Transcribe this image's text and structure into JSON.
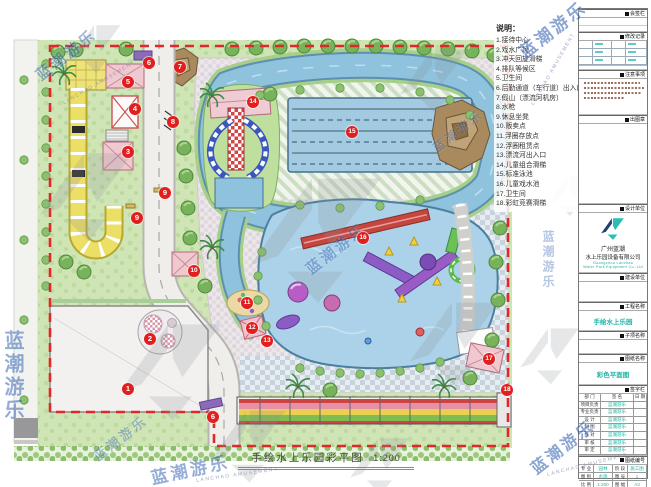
{
  "watermark": {
    "brand_cn": "蓝潮游乐",
    "brand_en": "LANCHAO AMUSEMENT"
  },
  "legend": {
    "title": "说明：",
    "items": [
      "1.接待中心",
      "2.戏水广场",
      "3.冲天回旋滑梯",
      "4.排队等候区",
      "5.卫生间",
      "6.后勤通道（车行道）出入口",
      "7.假山（漂流河机房）",
      "8.水枪",
      "9.休息坐凳",
      "10.贩卖点",
      "11.浮圈存放点",
      "12.浮圈租赁点",
      "13.漂流河出入口",
      "14.儿童组合滑梯",
      "15.标准泳池",
      "16.儿童戏水池",
      "17.卫生间",
      "18.彩虹竞赛滑梯"
    ]
  },
  "plan": {
    "title": "手绘水上乐园彩平图",
    "scale": "1:200",
    "markers": [
      {
        "num": "1",
        "x": 128,
        "y": 389
      },
      {
        "num": "2",
        "x": 150,
        "y": 339
      },
      {
        "num": "3",
        "x": 128,
        "y": 152
      },
      {
        "num": "4",
        "x": 135,
        "y": 109
      },
      {
        "num": "5",
        "x": 128,
        "y": 82
      },
      {
        "num": "6",
        "x": 149,
        "y": 63
      },
      {
        "num": "6",
        "x": 213,
        "y": 417
      },
      {
        "num": "7",
        "x": 180,
        "y": 67
      },
      {
        "num": "8",
        "x": 173,
        "y": 122
      },
      {
        "num": "9",
        "x": 165,
        "y": 193
      },
      {
        "num": "9",
        "x": 137,
        "y": 218
      },
      {
        "num": "10",
        "x": 194,
        "y": 271
      },
      {
        "num": "11",
        "x": 247,
        "y": 303
      },
      {
        "num": "12",
        "x": 252,
        "y": 328
      },
      {
        "num": "13",
        "x": 267,
        "y": 341
      },
      {
        "num": "14",
        "x": 253,
        "y": 102
      },
      {
        "num": "15",
        "x": 352,
        "y": 132
      },
      {
        "num": "16",
        "x": 363,
        "y": 238
      },
      {
        "num": "17",
        "x": 489,
        "y": 359
      },
      {
        "num": "18",
        "x": 507,
        "y": 390
      }
    ]
  },
  "titleblock": {
    "sections": {
      "s1": "会签栏",
      "s2": "修改记录",
      "s3": "注意事项",
      "s4": "出图章",
      "s5": "设计单位",
      "s6": "建设单位",
      "s7": "工程名称",
      "s8": "子项名称",
      "s9": "图纸名称",
      "s10": "签字栏",
      "s11": "图纸编号"
    },
    "company": {
      "name_line1": "广州蓝潮",
      "name_line2": "水上乐园设备有限公司",
      "en_line1": "Guangzhou Lanchao",
      "en_line2": "Water Park Equipment Co.,Ltd"
    },
    "project_name": "手绘水上乐园",
    "drawing_name": "彩色平面图",
    "sign_table": {
      "header": [
        "部 门",
        "签 名",
        "日 期"
      ],
      "rows": [
        [
          "项目负责人",
          "蓝潮游乐"
        ],
        [
          "专业负责人",
          "蓝潮游乐"
        ],
        [
          "设 计",
          "蓝潮游乐"
        ],
        [
          "制 图",
          "蓝潮游乐"
        ],
        [
          "校 对",
          "蓝潮游乐"
        ],
        [
          "审 核",
          "蓝潮游乐"
        ],
        [
          "审 定",
          "蓝潮游乐"
        ]
      ]
    },
    "info_table": {
      "rows": [
        [
          "专 业",
          "园林",
          "阶 段",
          "施工图"
        ],
        [
          "图 别",
          "水施",
          "图 号",
          "1"
        ],
        [
          "比 例",
          "1:200",
          "图 幅",
          "A3"
        ]
      ]
    },
    "date_label": "日期：",
    "date_value": "2016.07",
    "footer": "广州蓝潮水上乐园设备有限公司"
  }
}
